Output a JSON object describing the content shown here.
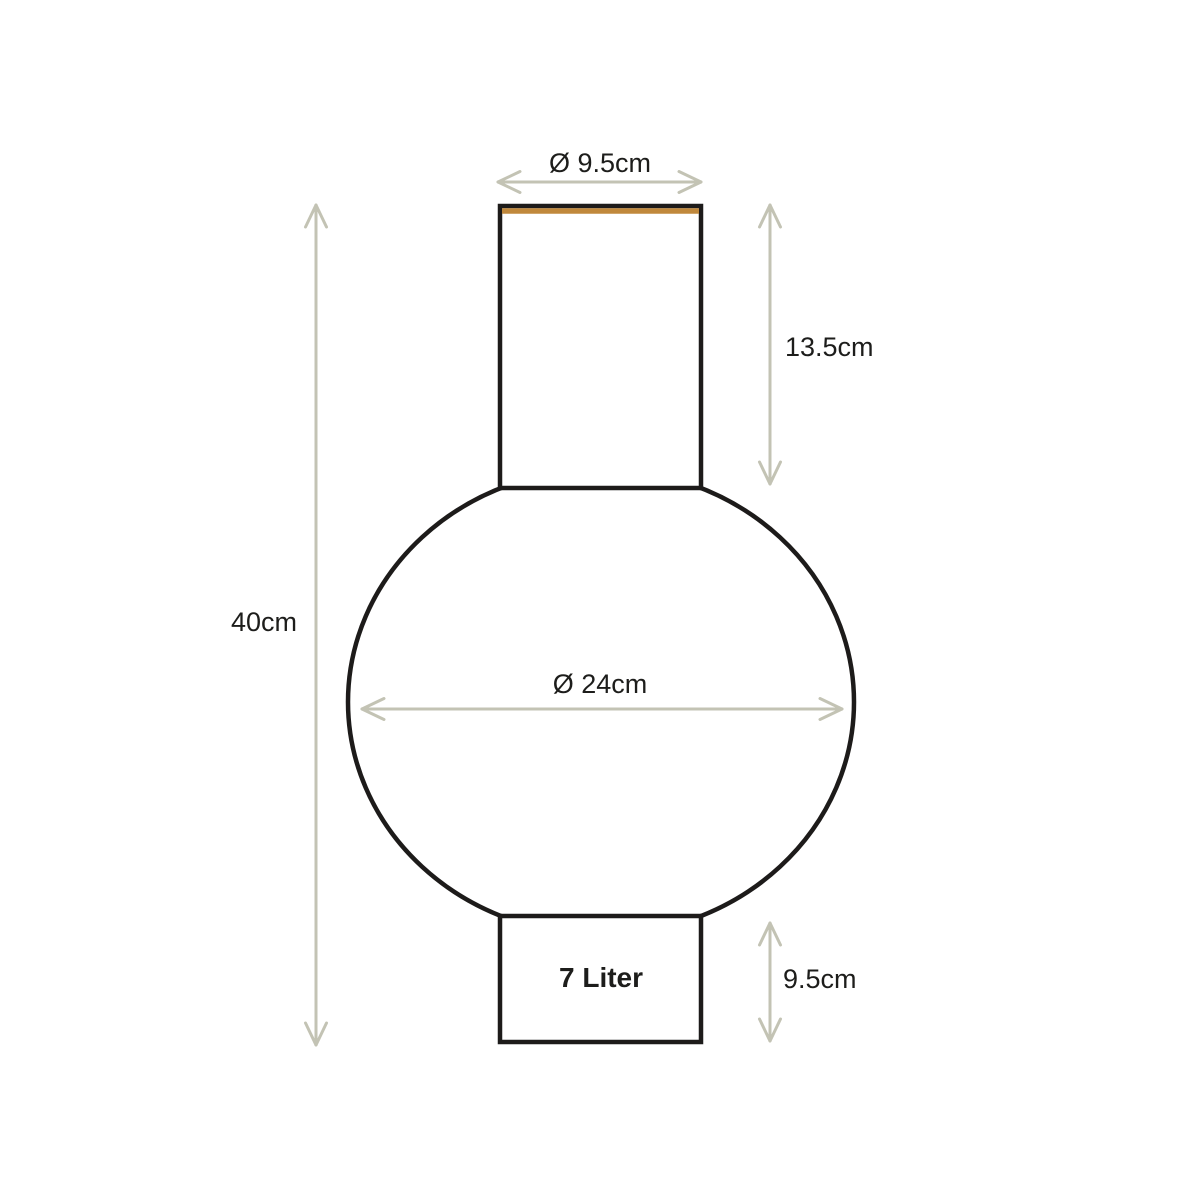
{
  "colors": {
    "background": "#ffffff",
    "outline": "#1d1b1a",
    "dimension_lines": "#c3c3b4",
    "rim_accent": "#c0883c",
    "label_text": "#1d1d1b"
  },
  "vase": {
    "capacity_label": "7 Liter",
    "neck_diameter_label": "Ø 9.5cm",
    "neck_height_label": "13.5cm",
    "total_height_label": "40cm",
    "body_diameter_label": "Ø 24cm",
    "base_height_label": "9.5cm"
  },
  "layout": {
    "canvas": {
      "width": 1200,
      "height": 1200
    },
    "body_ellipse": {
      "cx": 601,
      "cy": 702,
      "rx": 253,
      "ry": 233
    },
    "neck_rect": {
      "x": 500,
      "y": 206,
      "width": 201,
      "height": 282
    },
    "base_rect": {
      "x": 500,
      "y": 916,
      "width": 201,
      "height": 126
    },
    "rim_line": {
      "x1": 502,
      "y1": 211,
      "x2": 699,
      "y2": 211
    },
    "capacity_pos": {
      "x": 601,
      "y": 987
    }
  },
  "dimensions": [
    {
      "id": "neck-diameter",
      "label": "Ø 9.5cm",
      "orientation": "horizontal",
      "y": 182,
      "x1": 498,
      "x2": 701,
      "label_x": 600,
      "label_y": 172,
      "label_anchor": "middle"
    },
    {
      "id": "neck-height",
      "label": "13.5cm",
      "orientation": "vertical",
      "x": 770,
      "y1": 205,
      "y2": 484,
      "label_x": 785,
      "label_y": 356,
      "label_anchor": "start"
    },
    {
      "id": "total-height",
      "label": "40cm",
      "orientation": "vertical",
      "x": 316,
      "y1": 205,
      "y2": 1045,
      "label_x": 297,
      "label_y": 631,
      "label_anchor": "end"
    },
    {
      "id": "body-diameter",
      "label": "Ø 24cm",
      "orientation": "horizontal",
      "y": 709,
      "x1": 362,
      "x2": 842,
      "label_x": 600,
      "label_y": 693,
      "label_anchor": "middle"
    },
    {
      "id": "base-height",
      "label": "9.5cm",
      "orientation": "vertical",
      "x": 770,
      "y1": 923,
      "y2": 1041,
      "label_x": 783,
      "label_y": 988,
      "label_anchor": "start"
    }
  ]
}
